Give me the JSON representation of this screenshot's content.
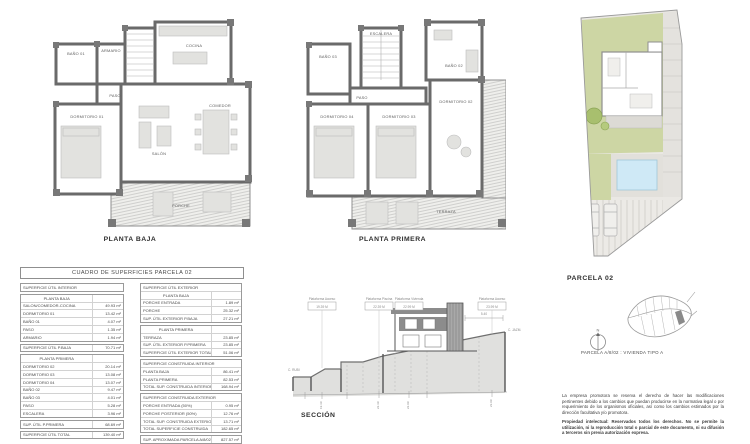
{
  "sheet": {
    "background": "#ffffff"
  },
  "colors": {
    "wall": "#6a6a6a",
    "furniture": "#e2e2df",
    "hatch_line": "#c2c2c0",
    "lawn": "#cdd6a4",
    "pool": "#cfe9f6",
    "paving": "#e7e5e1",
    "terrain_fill": "#e0e0de",
    "thin_line": "#9a9a9a"
  },
  "plans": {
    "ground": {
      "title": "PLANTA BAJA",
      "rooms": {
        "bano1": "BAÑO 01",
        "armario": "ARMARIO",
        "cocina": "COCINA",
        "paso": "PASO",
        "dormitorio1": "DORMITORIO 01",
        "salon": "SALÓN",
        "comedor": "COMEDOR",
        "porche": "PORCHE"
      }
    },
    "first": {
      "title": "PLANTA PRIMERA",
      "rooms": {
        "escalera": "ESCALERA",
        "bano3": "BAÑO 03",
        "bano2": "BAÑO 02",
        "paso": "PASO",
        "dormitorio4": "DORMITORIO 04",
        "dormitorio3": "DORMITORIO 03",
        "dormitorio2": "DORMITORIO 02",
        "terraza": "TERRAZA"
      }
    }
  },
  "site_plan": {
    "title": "PARCELA 02"
  },
  "surfaces_table": {
    "title": "CUADRO DE SUPERFICIES PARCELA 02",
    "columns": {
      "left": {
        "blocks": [
          [
            {
              "t": "h",
              "l": "SUPERFICIE ÚTIL INTERIOR",
              "v": ""
            }
          ],
          [
            {
              "t": "s",
              "l": "PLANTA BAJA",
              "v": ""
            },
            {
              "t": "i",
              "l": "SALON/COMEDOR-COCINA",
              "v": "49.93 m²"
            },
            {
              "t": "i",
              "l": "DORMITORIO 01",
              "v": "13.42 m²"
            },
            {
              "t": "i",
              "l": "BAÑO 01",
              "v": "4.07 m²"
            },
            {
              "t": "i",
              "l": "PASO",
              "v": "1.35 m²"
            },
            {
              "t": "i",
              "l": "ARMARIO",
              "v": "1.94 m²"
            }
          ],
          [
            {
              "t": "i",
              "l": "SUPERFICIE ÚTIL P.BAJA",
              "v": "70.71 m²"
            }
          ],
          [
            {
              "t": "s",
              "l": "PLANTA PRIMERA",
              "v": ""
            },
            {
              "t": "i",
              "l": "DORMITORIO 02",
              "v": "20.14 m²"
            },
            {
              "t": "i",
              "l": "DORMITORIO 03",
              "v": "13.08 m²"
            },
            {
              "t": "i",
              "l": "DORMITORIO 04",
              "v": "13.07 m²"
            },
            {
              "t": "i",
              "l": "BAÑO 02",
              "v": "9.47 m²"
            },
            {
              "t": "i",
              "l": "BAÑO 03",
              "v": "4.01 m²"
            },
            {
              "t": "i",
              "l": "PASO",
              "v": "5.28 m²"
            },
            {
              "t": "i",
              "l": "ESCALERA",
              "v": "3.96 m²"
            }
          ],
          [
            {
              "t": "i",
              "l": "SUP. ÚTIL P.PRIMERA",
              "v": "68.69 m²"
            }
          ],
          [
            {
              "t": "i",
              "l": "SUPERFICIE ÚTIL TOTAL",
              "v": "139.40 m²"
            }
          ]
        ]
      },
      "right": {
        "blocks": [
          [
            {
              "t": "h",
              "l": "SUPERFICIE ÚTIL EXTERIOR",
              "v": ""
            },
            {
              "t": "s",
              "l": "PLANTA BAJA",
              "v": ""
            },
            {
              "t": "i",
              "l": "PORCHE ENTRADA",
              "v": "1.89 m²"
            },
            {
              "t": "i",
              "l": "PORCHE",
              "v": "25.32 m²"
            },
            {
              "t": "i",
              "l": "SUP. ÚTIL EXTERIOR P.BAJA",
              "v": "27.21 m²"
            }
          ],
          [
            {
              "t": "s",
              "l": "PLANTA PRIMERA",
              "v": ""
            },
            {
              "t": "i",
              "l": "TERRAZA",
              "v": "23.85 m²"
            },
            {
              "t": "i",
              "l": "SUP. ÚTIL EXTERIOR P.PRIMERA",
              "v": "23.85 m²"
            },
            {
              "t": "i",
              "l": "SUPERFICIE ÚTIL EXTERIOR TOTAL",
              "v": "51.06 m²"
            }
          ],
          [
            {
              "t": "h",
              "l": "SUPERFICIE CONSTRUIDA INTERIOR",
              "v": ""
            },
            {
              "t": "i",
              "l": "PLANTA BAJA",
              "v": "86.41 m²"
            },
            {
              "t": "i",
              "l": "PLANTA PRIMERA",
              "v": "82.53 m²"
            },
            {
              "t": "i",
              "l": "TOTAL SUP. CONSTRUIDA INTERIOR",
              "v": "168.94 m²"
            }
          ],
          [
            {
              "t": "h",
              "l": "SUPERFICIE CONSTRUIDA EXTERIOR",
              "v": ""
            },
            {
              "t": "i",
              "l": "PORCHE ENTRADA (50%)",
              "v": "0.95 m²"
            },
            {
              "t": "i",
              "l": "PORCHE POSTERIOR (50%)",
              "v": "12.76 m²"
            },
            {
              "t": "i",
              "l": "TOTAL SUP. CONSTRUIDA EXTERIOR",
              "v": "13.71 m²"
            },
            {
              "t": "i",
              "l": "TOTAL SUPERFICIE CONSTRUIDA",
              "v": "182.65 m²"
            }
          ],
          [
            {
              "t": "i",
              "l": "SUP. APROXIMADA PARCELA A/8/02",
              "v": "827.57 m²"
            }
          ]
        ]
      }
    }
  },
  "section": {
    "title": "SECCIÓN",
    "platforms": [
      {
        "name": "Plataforma Acceso",
        "level": "19.39 M"
      },
      {
        "name": "Plataforma Piscina",
        "level": "22.39 M"
      },
      {
        "name": "Plataforma Vivienda",
        "level": "22.99 M"
      },
      {
        "name": "Plataforma Acceso",
        "level": "23.99 M"
      }
    ],
    "dimension": "5.40",
    "street_left": "C. RUBI",
    "street_right": "C. JAZM.",
    "ticks": [
      "19.39",
      "22.39",
      "22.99",
      "23.99"
    ]
  },
  "location": {
    "caption": "PARCELA A/8/02 : VIVIENDA TIPO A",
    "north": "N"
  },
  "legal": {
    "p1": "La empresa promotora se reserva el derecho de hacer las modificaciones pertinentes debido a los cambios que puedan producirse en la normativa legal o por requerimiento de los organismos oficiales, así como los cambios estimados por la dirección facultativa y/o promotora.",
    "p2": "Propiedad intelectual: Reservados todos los derechos. No se permite la utilización, ni la reproducción total o parcial de este documento, ni su difusión a terceros sin previa autorización expresa."
  }
}
